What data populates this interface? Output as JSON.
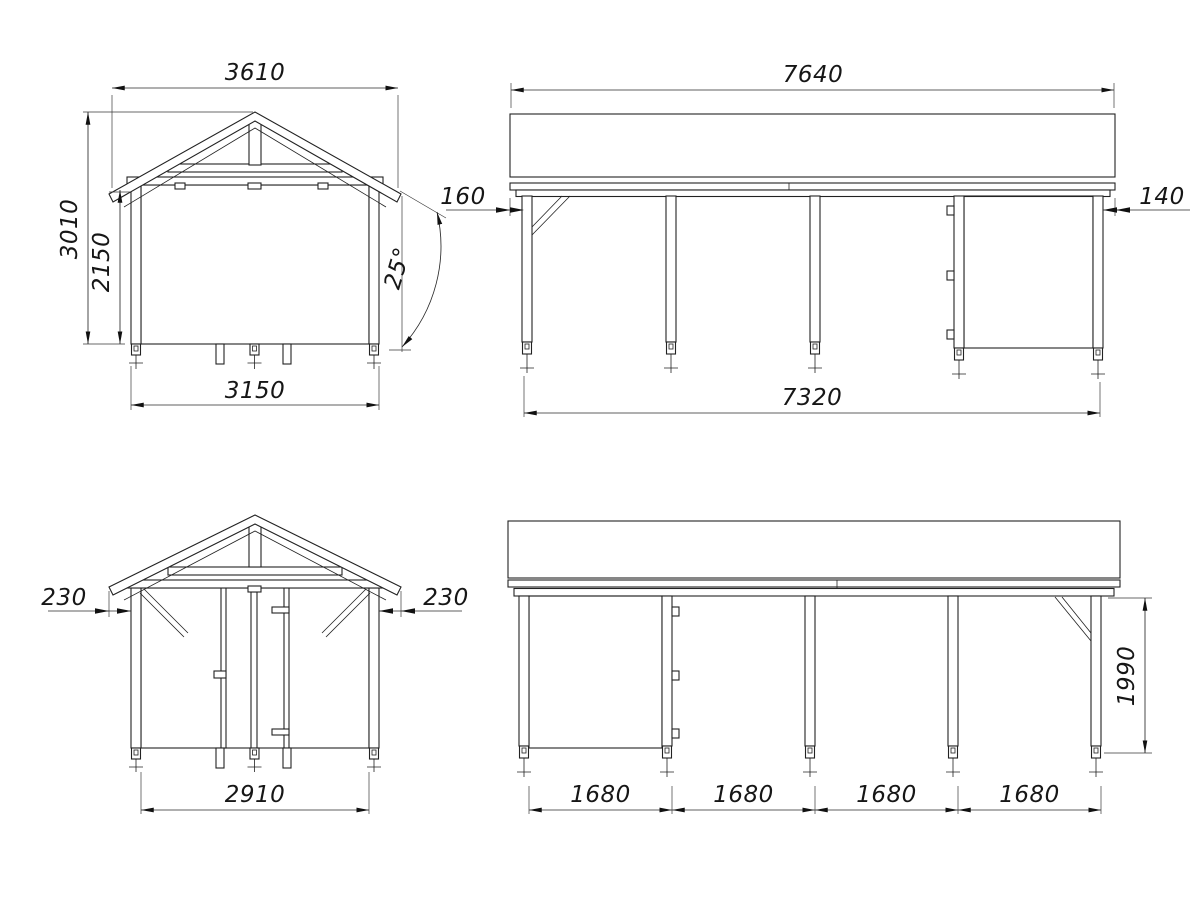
{
  "page": {
    "background": "#ffffff",
    "ink": "#222222"
  },
  "views": {
    "front": {
      "dim_roof_width": "3610",
      "dim_total_height": "3010",
      "dim_wall_height": "2150",
      "dim_base_width": "3150",
      "dim_roof_angle": "25°"
    },
    "side_a": {
      "dim_roof_length": "7640",
      "dim_overhang_left": "160",
      "dim_overhang_right": "140",
      "dim_post_span": "7320"
    },
    "rear": {
      "dim_overhang_left": "230",
      "dim_overhang_right": "230",
      "dim_inner_width": "2910"
    },
    "side_b": {
      "dim_bays": [
        "1680",
        "1680",
        "1680",
        "1680"
      ],
      "dim_post_height": "1990"
    }
  }
}
